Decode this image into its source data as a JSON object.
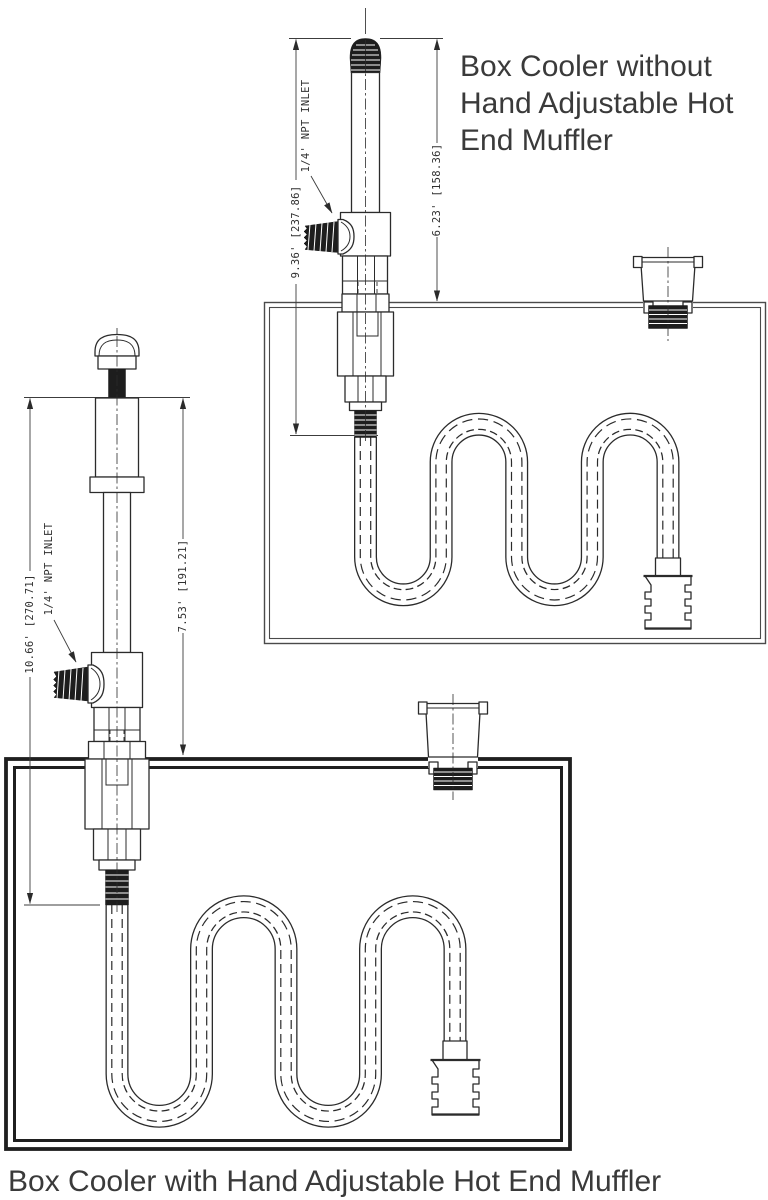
{
  "top_diagram": {
    "title_lines": [
      "Box Cooler without",
      "Hand Adjustable Hot",
      "End Muffler"
    ],
    "dim_overall": "9.36' [237.86]",
    "dim_above_box": "6.23' [158.36]",
    "inlet_label": "1/4' NPT INLET"
  },
  "bottom_diagram": {
    "caption": "Box Cooler with Hand Adjustable Hot End Muffler",
    "dim_overall": "10.66' [270.71]",
    "dim_above_box": "7.53' [191.21]",
    "inlet_label": "1/4' NPT INLET"
  },
  "colors": {
    "ink": "#2b2b2b",
    "text": "#3a3a3a",
    "background": "#ffffff"
  }
}
